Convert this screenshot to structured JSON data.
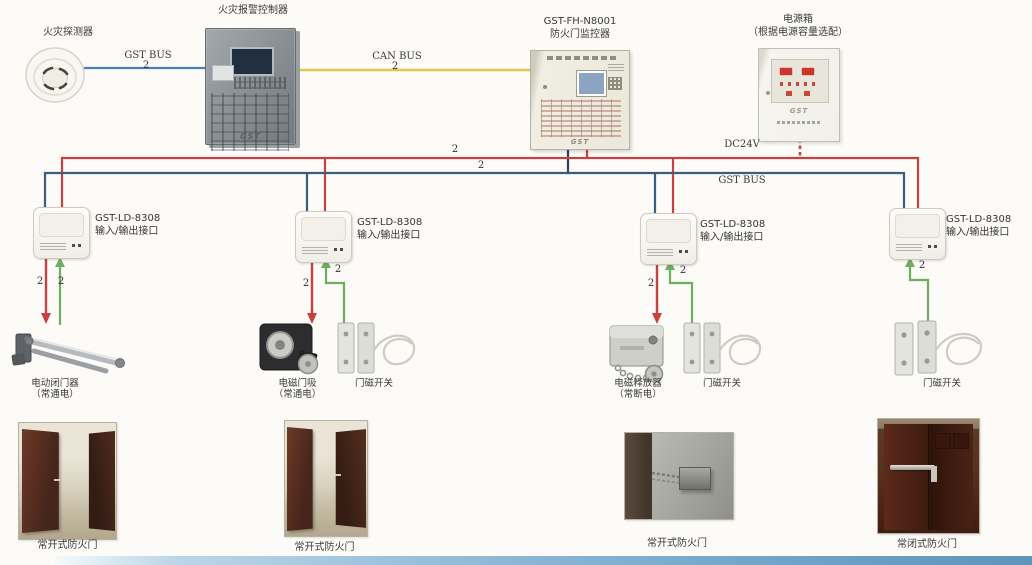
{
  "diagram_title": "防火门监控系统接线图",
  "top_devices": {
    "detector": {
      "label": "火灾探测器"
    },
    "controller": {
      "label": "火灾报警控制器",
      "logo": "GST"
    },
    "monitor": {
      "model": "GST-FH-N8001",
      "name": "防火门监控器",
      "logo": "GST"
    },
    "power": {
      "name": "电源箱",
      "note": "（根据电源容量选配）",
      "logo": "GST"
    }
  },
  "buses": {
    "gst_bus_top": {
      "label": "GST BUS",
      "count": "2",
      "color": "#4a7fb5"
    },
    "can_bus": {
      "label": "CAN BUS",
      "count": "2",
      "color": "#e3c44c"
    },
    "dc24v": {
      "label": "DC24V",
      "count": "2",
      "color": "#c94040"
    },
    "gst_bus_main": {
      "label": "GST BUS",
      "count": "2",
      "color": "#3c5d82"
    }
  },
  "modules": [
    {
      "model": "GST-LD-8308",
      "name": "输入/输出接口"
    },
    {
      "model": "GST-LD-8308",
      "name": "输入/输出接口"
    },
    {
      "model": "GST-LD-8308",
      "name": "输入/输出接口"
    },
    {
      "model": "GST-LD-8308",
      "name": "输入/输出接口"
    }
  ],
  "wire_counts": {
    "m1_red": "2",
    "m1_green": "2",
    "m2_red": "2",
    "m2_green": "2",
    "m3_red": "2",
    "m3_green": "2",
    "m4_green": "2"
  },
  "field_devices": {
    "door_closer": {
      "name": "电动闭门器",
      "note": "（常通电）"
    },
    "door_holder": {
      "name": "电磁门吸",
      "note": "（常通电）"
    },
    "door_switch_2": {
      "name": "门磁开关"
    },
    "door_releaser": {
      "name": "电磁释放器",
      "note": "（常断电）"
    },
    "door_switch_3": {
      "name": "门磁开关"
    },
    "door_switch_4": {
      "name": "门磁开关"
    }
  },
  "doors": [
    {
      "label": "常开式防火门"
    },
    {
      "label": "常开式防火门"
    },
    {
      "label": "常开式防火门"
    },
    {
      "label": "常闭式防火门"
    }
  ]
}
